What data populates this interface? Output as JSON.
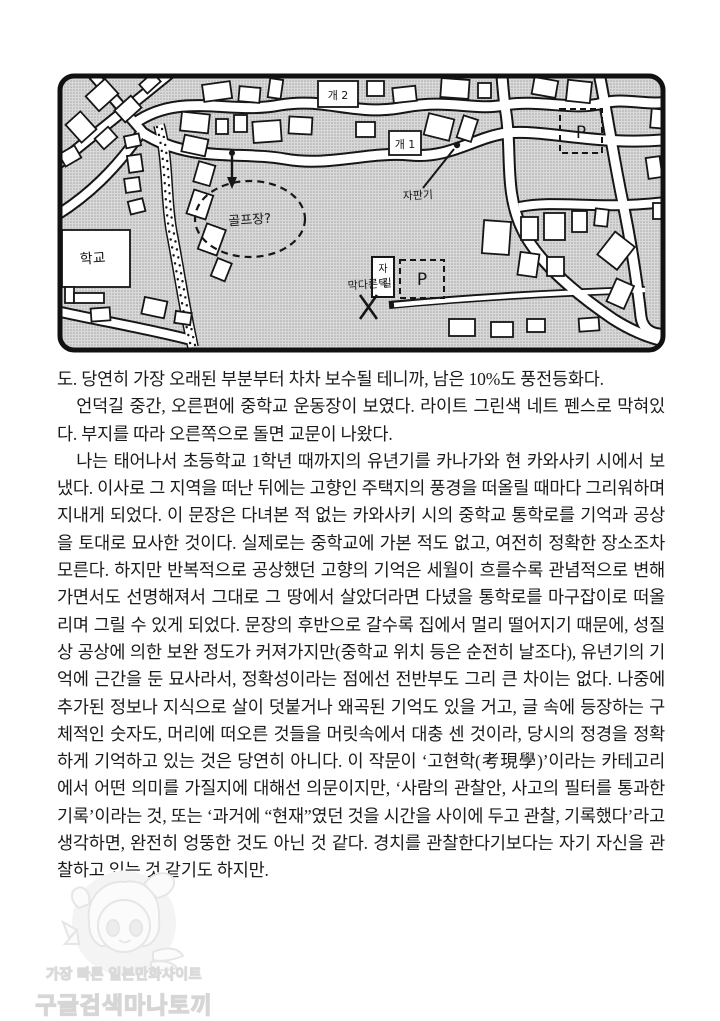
{
  "page_type": "book-page-scan",
  "map": {
    "labels": {
      "dog2": "개 2",
      "dog1": "개 1",
      "vending": "자판기",
      "golf": "골프장?",
      "school": "학교",
      "home_top": "자",
      "home_bottom": "택",
      "parking_ne": "P",
      "parking_se": "P",
      "dead_end": "막다른 길"
    }
  },
  "body": {
    "paragraphs": [
      {
        "text": "도. 당연히 가장 오래된 부분부터 차차 보수될 테니까, 남은 10%도 풍전등화다."
      },
      {
        "text": "언덕길 중간, 오른편에 중학교 운동장이 보였다. 라이트 그린색 네트 펜스로 막혀있다. 부지를 따라 오른쪽으로 돌면 교문이 나왔다."
      },
      {
        "text": "나는 태어나서 초등학교 1학년 때까지의 유년기를 카나가와 현 카와사키 시에서 보냈다. 이사로 그 지역을 떠난 뒤에는 고향인 주택지의 풍경을 떠올릴 때마다 그리워하며 지내게 되었다. 이 문장은 다녀본 적 없는 카와사키 시의 중학교 통학로를 기억과 공상을 토대로 묘사한 것이다. 실제로는 중학교에 가본 적도 없고, 여전히 정확한 장소조차 모른다. 하지만 반복적으로 공상했던 고향의 기억은 세월이 흐를수록 관념적으로 변해가면서도 선명해져서 그대로 그 땅에서 살았더라면 다녔을 통학로를 마구잡이로 떠올리며 그릴 수 있게 되었다. 문장의 후반으로 갈수록 집에서 멀리 떨어지기 때문에, 성질상 공상에 의한 보완 정도가 커져가지만(중학교 위치 등은 순전히 날조다), 유년기의 기억에 근간을 둔 묘사라서, 정확성이라는 점에선 전반부도 그리 큰 차이는 없다. 나중에 추가된 정보나 지식으로 살이 덧붙거나 왜곡된 기억도 있을 거고, 글 속에 등장하는 구체적인 숫자도, 머리에 떠오른 것들을 머릿속에서 대충 센 것이라, 당시의 정경을 정확하게 기억하고 있는 것은 당연히 아니다. 이 작문이 ‘고현학(考現學)’이라는 카테고리에서 어떤 의미를 가질지에 대해선 의문이지만, ‘사람의 관찰안, 사고의 필터를 통과한 기록’이라는 것, 또는 ‘과거에 “현재”였던 것을 시간을 사이에 두고 관찰, 기록했다’라고 생각하면, 완전히 엉뚱한 것도 아닌 것 같다. 경치를 관찰한다기보다는 자기 자신을 관찰하고 있는 것 같기도 하지만."
      }
    ]
  },
  "watermark": {
    "line1": "가장 빠른 일본만화사이트",
    "line2": "구글검색마나토끼"
  },
  "colors": {
    "ink": "#161616",
    "paper": "#ffffff",
    "halftone": "#d9d9d9",
    "watermark_gray": "#dadada"
  }
}
